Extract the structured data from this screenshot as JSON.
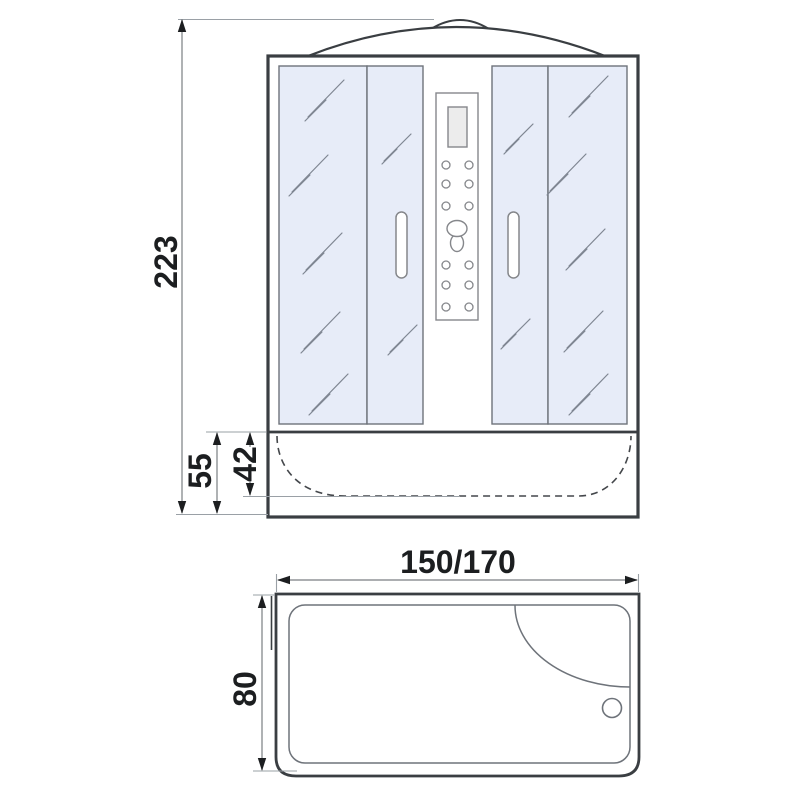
{
  "drawing": {
    "dimension_labels": {
      "total_height": "223",
      "base_height": "55",
      "base_inner_depth": "42",
      "width_variants": "150/170",
      "tray_depth": "80"
    },
    "colors": {
      "background": "#ffffff",
      "glass_fill": "#e7ecf8",
      "outline_dark": "#3a3e42",
      "outline_gray": "#6e737a",
      "reflection_gray": "#7f8692",
      "dimension_line": "#7a7e82",
      "extension_line": "#9aa0a6",
      "dimension_text": "#1c1e20",
      "display_fill": "#ececec"
    }
  }
}
